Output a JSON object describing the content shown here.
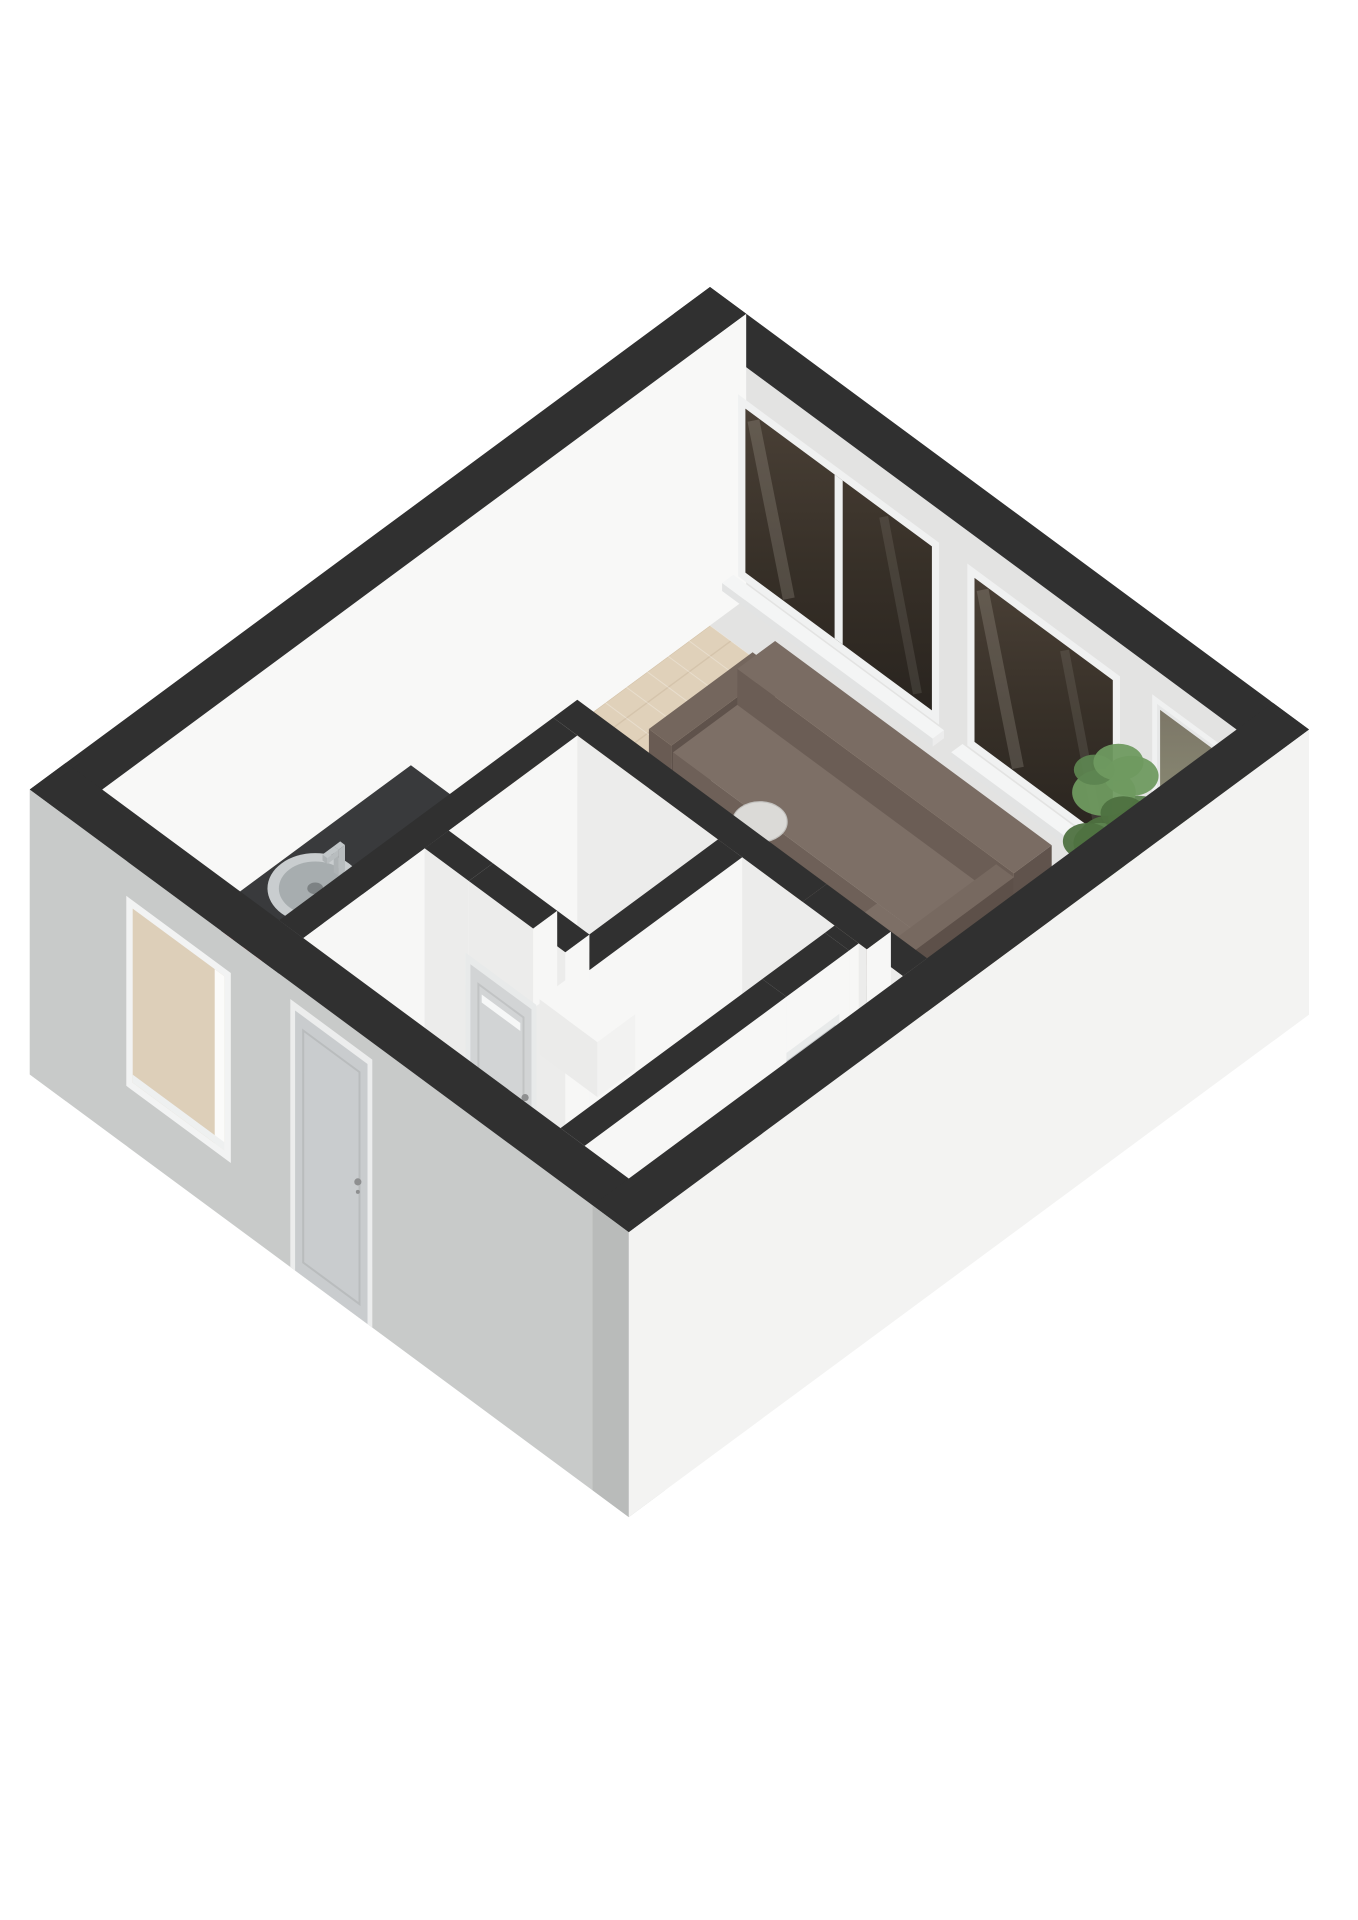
{
  "meta": {
    "kind": "isometric-3d-floorplan-render",
    "background": "#ffffff"
  },
  "projection": {
    "cx": 710,
    "cy": 287,
    "ax": 0.804,
    "ay": 0.594,
    "wallHeight": 285
  },
  "palette": {
    "wall_cut_top": "#303030",
    "wall_inner_bright": "#f8f8f7",
    "wall_inner_shaded": "#e3e3e2",
    "wall_outer_light": "#f3f3f2",
    "wall_outer_grey": "#c8cac9",
    "floor_wood": "#e0d1ba",
    "floor_white": "#f0f0ee",
    "rug": "#e8e5da",
    "sofa_brown": "#6e6058",
    "counter_dark": "#393a3c",
    "stove_black": "#161616",
    "burner_red": "#d0342b",
    "glass_dark": "#3f372e",
    "door_grey": "#c9ccce",
    "plant_green": "#5d8450"
  },
  "scene": {
    "items": [
      {
        "type": "floor",
        "name": "floor-wood-herringbone",
        "fill": "#e0d1ba",
        "wood": true,
        "pts": [
          [
            45,
            45
          ],
          [
            700,
            45
          ],
          [
            700,
            430
          ],
          [
            295,
            430
          ],
          [
            295,
            801
          ],
          [
            45,
            801
          ]
        ]
      },
      {
        "type": "flat",
        "name": "floor-white-hall",
        "fill": "#f0f0ee",
        "h": 0,
        "pts": [
          [
            295,
            430
          ],
          [
            700,
            430
          ],
          [
            700,
            801
          ],
          [
            295,
            801
          ]
        ]
      },
      {
        "type": "flat",
        "name": "area-rug",
        "fill": "#e8e5da",
        "h": 1,
        "pts": [
          [
            138,
            72
          ],
          [
            585,
            72
          ],
          [
            585,
            330
          ],
          [
            138,
            330
          ]
        ]
      },
      {
        "type": "box",
        "name": "wall-north",
        "b": [
          0,
          0,
          745,
          45,
          0,
          285
        ],
        "top": "#303030",
        "sw": "#e3e3e2",
        "se": "#ededec"
      },
      {
        "type": "box",
        "name": "wall-west",
        "b": [
          0,
          0,
          45,
          846,
          0,
          285
        ],
        "top": "#303030",
        "sw": "#d8d8d7",
        "se": "#f8f8f7"
      },
      {
        "type": "window",
        "name": "living-window-1",
        "y": 45,
        "x1": 80,
        "x2": 330,
        "h1": 70,
        "h2": 252,
        "panes": 2
      },
      {
        "type": "window",
        "name": "living-window-2",
        "y": 45,
        "x1": 365,
        "x2": 555,
        "h1": 70,
        "h2": 252,
        "panes": 1
      },
      {
        "type": "glassdoor",
        "name": "balcony-glass-door",
        "y": 45,
        "x1": 595,
        "x2": 682,
        "h1": 0,
        "h2": 258
      },
      {
        "type": "plant",
        "name": "potted-plant",
        "x": 602,
        "y": 102
      },
      {
        "type": "lamp",
        "name": "floor-lamp",
        "x": 670,
        "y": 96
      },
      {
        "type": "disc",
        "name": "sofa-shadow",
        "x": 340,
        "y": 235,
        "h": 0,
        "r": 185,
        "fill": "rgba(0,0,0,0.05)"
      },
      {
        "type": "box",
        "name": "sofa-arm-left",
        "b": [
          148,
          95,
          176,
          224,
          0,
          64
        ],
        "top": "#74665d",
        "sw": "#695b53",
        "se": "#5f524b"
      },
      {
        "type": "box",
        "name": "sofa-backrest",
        "b": [
          176,
          95,
          520,
          142,
          0,
          92
        ],
        "top": "#7a6c63",
        "sw": "#6b5d55",
        "se": "#60534c"
      },
      {
        "type": "box",
        "name": "sofa-seat",
        "b": [
          176,
          142,
          498,
          222,
          0,
          56
        ],
        "top": "#7d6f66",
        "sw": "#6e6058",
        "se": "#63564e"
      },
      {
        "type": "box",
        "name": "sofa-chaise",
        "b": [
          430,
          222,
          498,
          352,
          0,
          56
        ],
        "top": "#7d6f66",
        "sw": "#6e6058",
        "se": "#63564e"
      },
      {
        "type": "box",
        "name": "sofa-backrest-right",
        "b": [
          498,
          142,
          520,
          352,
          0,
          88
        ],
        "top": "#776960",
        "sw": "#685a52",
        "se": "#5d5049"
      },
      {
        "type": "box",
        "name": "coffee-table-wood",
        "b": [
          330,
          230,
          428,
          304,
          0,
          42
        ],
        "top": "#8b7256",
        "sw": "#74604a",
        "se": "#66533e"
      },
      {
        "type": "box",
        "name": "coffee-table-marble",
        "b": [
          300,
          255,
          420,
          335,
          0,
          34
        ],
        "top": "#2a2a2c",
        "sw": "#222224",
        "se": "#1d1d1f"
      },
      {
        "type": "bouquet",
        "name": "coffee-table-flowers",
        "x": 358,
        "y": 296,
        "h": 36,
        "r": 24
      },
      {
        "type": "chair",
        "name": "dining-chair-north",
        "x": 312,
        "y": 272,
        "dir": "N"
      },
      {
        "type": "box",
        "name": "dining-table-pedestal",
        "b": [
          305,
          330,
          355,
          366,
          0,
          70
        ],
        "top": "#2c2c2e",
        "sw": "#242426",
        "se": "#202022"
      },
      {
        "type": "box",
        "name": "dining-table-top",
        "b": [
          228,
          302,
          422,
          394,
          70,
          78
        ],
        "top": "#404042",
        "sw": "#353537",
        "se": "#2f2f31"
      },
      {
        "type": "box",
        "name": "dining-vase",
        "b": [
          318,
          341,
          334,
          357,
          78,
          98
        ],
        "top": "#b3b9b0",
        "sw": "#a8afa7",
        "se": "#9ba29a"
      },
      {
        "type": "bouquet",
        "name": "dining-flowers",
        "x": 326,
        "y": 349,
        "h": 96,
        "r": 22
      },
      {
        "type": "chair",
        "name": "dining-chair-south-1",
        "x": 300,
        "y": 410,
        "dir": "S"
      },
      {
        "type": "chair",
        "name": "dining-chair-south-2",
        "x": 382,
        "y": 412,
        "dir": "S"
      },
      {
        "type": "chair",
        "name": "dining-chair-west",
        "x": 198,
        "y": 340,
        "dir": "W"
      },
      {
        "type": "box",
        "name": "kitchen-cabinets",
        "b": [
          48,
          420,
          128,
          738,
          0,
          70
        ],
        "top": "#fafafa",
        "sw": "#eeeeee",
        "se": "#fbfbfb"
      },
      {
        "type": "box",
        "name": "kitchen-countertop",
        "b": [
          44,
          416,
          134,
          742,
          70,
          80
        ],
        "top": "#393a3c",
        "sw": "#2c2d2f",
        "se": "#323335"
      },
      {
        "type": "sink",
        "name": "kitchen-sink",
        "x": 89,
        "y": 580,
        "h": 80
      },
      {
        "type": "stove",
        "name": "kitchen-stove",
        "b": [
          50,
          652,
          128,
          740,
          80,
          84
        ]
      },
      {
        "type": "box",
        "name": "kitchen-tall-cabinet",
        "b": [
          46,
          744,
          136,
          798,
          0,
          168
        ],
        "top": "#f6f6f5",
        "sw": "#eaeaea",
        "se": "#f8f8f7"
      },
      {
        "type": "box",
        "name": "wall-hall-a",
        "b": [
          265,
          430,
          575,
          460,
          0,
          285
        ],
        "top": "#303030",
        "sw": "#ececeb",
        "se": "#f7f7f6"
      },
      {
        "type": "box",
        "name": "wall-hall-b",
        "b": [
          655,
          430,
          700,
          460,
          0,
          285
        ],
        "top": "#303030",
        "sw": "#ececeb",
        "se": "#f7f7f6"
      },
      {
        "type": "box",
        "name": "wall-hall-lintel",
        "b": [
          575,
          430,
          655,
          460,
          205,
          285
        ],
        "top": "#303030",
        "sw": "#ececeb",
        "se": "#f7f7f6"
      },
      {
        "type": "door",
        "name": "living-room-door",
        "y": 460,
        "x1": 578,
        "x2": 652,
        "h1": 0,
        "h2": 203,
        "leaf": "#c6c9cb",
        "handleX": 644,
        "handleH": 105
      },
      {
        "type": "box",
        "name": "wall-kitchen-divider",
        "b": [
          265,
          460,
          295,
          801,
          0,
          285
        ],
        "top": "#303030",
        "sw": "#ececeb",
        "se": "#f7f7f6"
      },
      {
        "type": "box",
        "name": "wall-wc-east",
        "b": [
          470,
          460,
          500,
          650,
          0,
          285
        ],
        "top": "#303030",
        "sw": "#ececeb",
        "se": "#f7f7f6"
      },
      {
        "type": "box",
        "name": "wall-wc-south-a",
        "b": [
          295,
          620,
          350,
          650,
          0,
          285
        ],
        "top": "#303030",
        "sw": "#ececeb",
        "se": "#f7f7f6"
      },
      {
        "type": "box",
        "name": "wall-wc-south-b",
        "b": [
          430,
          620,
          470,
          650,
          0,
          285
        ],
        "top": "#303030",
        "sw": "#ececeb",
        "se": "#f7f7f6"
      },
      {
        "type": "box",
        "name": "wall-wc-lintel",
        "b": [
          350,
          620,
          430,
          650,
          205,
          285
        ],
        "top": "#303030",
        "sw": "#ececeb",
        "se": "#f7f7f6"
      },
      {
        "type": "door",
        "name": "wc-door",
        "y": 650,
        "x1": 352,
        "x2": 428,
        "h1": 0,
        "h2": 203,
        "leaf": "#d2d4d5",
        "slit": true,
        "handleX": 420,
        "handleH": 110
      },
      {
        "type": "box",
        "name": "wc-fixture",
        "b": [
          300,
          465,
          372,
          512,
          0,
          55
        ],
        "top": "#f7f7f6",
        "sw": "#ebebea",
        "se": "#f2f2f1"
      },
      {
        "type": "box",
        "name": "stair-step-1",
        "b": [
          520,
          465,
          615,
          528,
          0,
          78
        ],
        "top": "#f4f4f3",
        "sw": "#e6e6e5",
        "se": "#dcdcdb"
      },
      {
        "type": "box",
        "name": "stair-step-2",
        "b": [
          520,
          528,
          615,
          572,
          0,
          52
        ],
        "top": "#f4f4f3",
        "sw": "#e6e6e5",
        "se": "#dcdcdb"
      },
      {
        "type": "box",
        "name": "stair-step-3",
        "b": [
          520,
          572,
          615,
          616,
          0,
          28
        ],
        "top": "#f4f4f3",
        "sw": "#e6e6e5",
        "se": "#dcdcdb"
      },
      {
        "type": "box",
        "name": "stair-step-4",
        "b": [
          520,
          616,
          615,
          655,
          0,
          10
        ],
        "top": "#f4f4f3",
        "sw": "#e6e6e5",
        "se": "#dcdcdb"
      },
      {
        "type": "flat",
        "name": "stairwell-opening",
        "fill": "#262626",
        "h": 0,
        "pts": [
          [
            520,
            655
          ],
          [
            615,
            655
          ],
          [
            615,
            790
          ],
          [
            520,
            790
          ]
        ]
      },
      {
        "type": "box",
        "name": "wall-bedroom-a",
        "b": [
          615,
          460,
          645,
          472,
          0,
          285
        ],
        "top": "#303030",
        "sw": "#ececeb",
        "se": "#f7f7f6"
      },
      {
        "type": "box",
        "name": "wall-bedroom-lintel",
        "b": [
          615,
          472,
          645,
          550,
          205,
          285
        ],
        "top": "#303030",
        "sw": "#ececeb",
        "se": "#f7f7f6"
      },
      {
        "type": "doorx",
        "name": "bedroom-door",
        "x": 630,
        "y1": 474,
        "y2": 548,
        "h1": 0,
        "h2": 203,
        "leaf": "#c6c9cb"
      },
      {
        "type": "box",
        "name": "wall-bedroom-b",
        "b": [
          615,
          550,
          645,
          801,
          0,
          285
        ],
        "top": "#303030",
        "sw": "#ececeb",
        "se": "#f7f7f6"
      },
      {
        "type": "box",
        "name": "hall-console",
        "b": [
          480,
          735,
          590,
          795,
          0,
          66
        ],
        "top": "#f7f7f6",
        "sw": "#ebebea",
        "se": "#f1f1f0"
      },
      {
        "type": "bottles",
        "name": "console-bottles",
        "x0": 496,
        "y": 760,
        "n": 4,
        "dx": 20,
        "h": 66
      },
      {
        "type": "box",
        "name": "wall-south",
        "b": [
          0,
          801,
          745,
          846,
          0,
          285
        ],
        "top": "#303030",
        "sw": "#c8cac9",
        "se": "#bfc1c0"
      },
      {
        "type": "openwindow",
        "name": "kitchen-window",
        "y": 846,
        "x1": 120,
        "x2": 250,
        "h1": 60,
        "h2": 250
      },
      {
        "type": "door",
        "name": "front-door",
        "y": 846,
        "x1": 330,
        "x2": 420,
        "h1": 0,
        "h2": 260,
        "leaf": "#c9ccce",
        "frame": "#eceded",
        "handleX": 408,
        "handleH": 135
      },
      {
        "type": "box",
        "name": "wall-east",
        "b": [
          700,
          0,
          745,
          846,
          0,
          285
        ],
        "top": "#303030",
        "sw": "#b9bbba",
        "se": "#f3f3f2"
      }
    ]
  }
}
